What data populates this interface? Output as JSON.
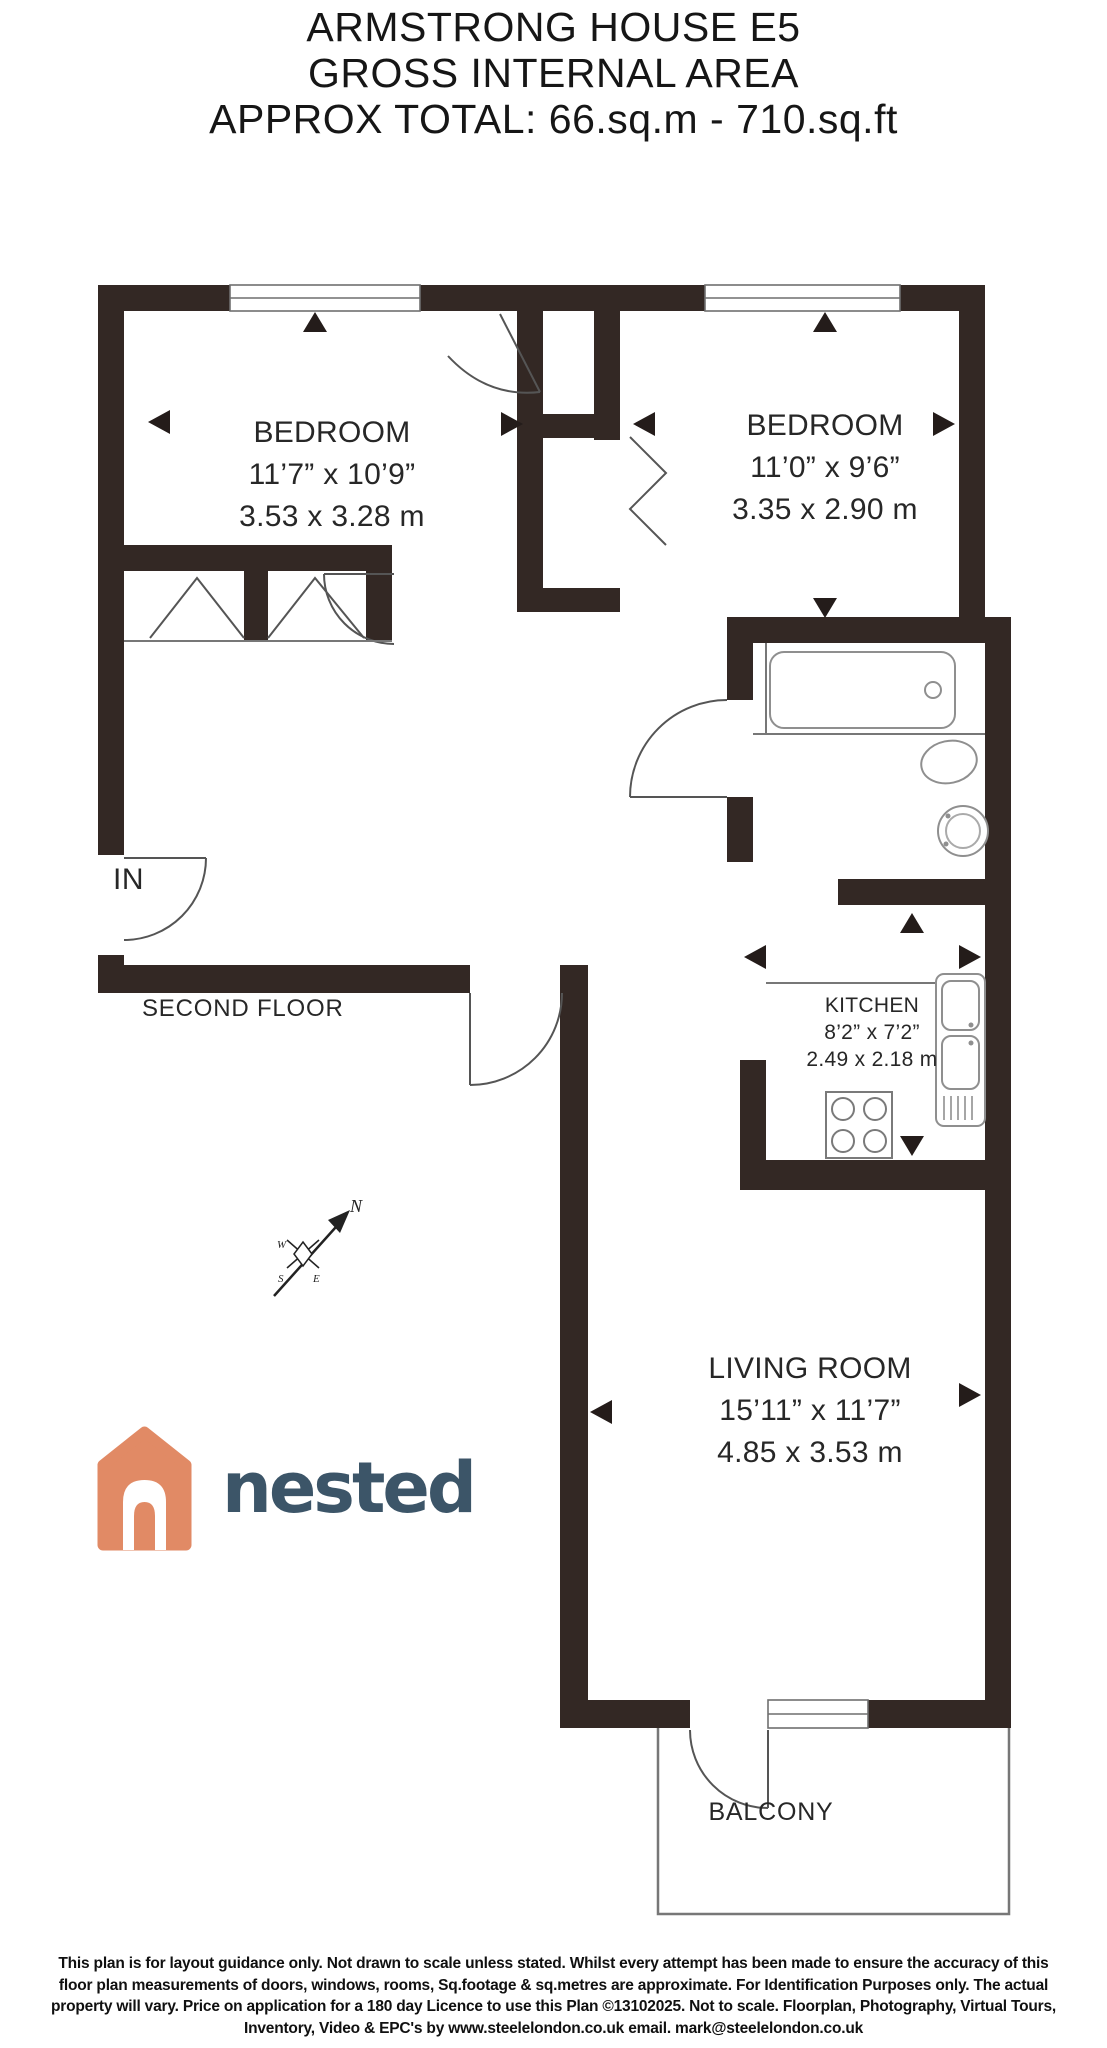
{
  "title": {
    "line1": "ARMSTRONG HOUSE E5",
    "line2": "GROSS INTERNAL AREA",
    "line3": "APPROX TOTAL: 66.sq.m - 710.sq.ft"
  },
  "entrance_label": "IN",
  "floor_label": "SECOND FLOOR",
  "rooms": {
    "bedroom1": {
      "name": "BEDROOM",
      "imperial": "11’7” x 10’9”",
      "metric": "3.53 x 3.28 m"
    },
    "bedroom2": {
      "name": "BEDROOM",
      "imperial": "11’0” x 9’6”",
      "metric": "3.35 x 2.90 m"
    },
    "kitchen": {
      "name": "KITCHEN",
      "imperial": "8’2” x 7’2”",
      "metric": "2.49 x 2.18 m"
    },
    "living_room": {
      "name": "LIVING ROOM",
      "imperial": "15’11” x 11’7”",
      "metric": "4.85 x 3.53 m"
    },
    "balcony": {
      "name": "BALCONY"
    }
  },
  "compass": {
    "n": "N",
    "e": "E",
    "s": "S",
    "w": "W"
  },
  "logo": {
    "text": "nested",
    "icon_color": "#E18A65",
    "text_color": "#3C5568"
  },
  "colors": {
    "wall": "#332824",
    "label_text": "#272727"
  },
  "disclaimer": {
    "lines": [
      "This plan is for layout guidance only. Not drawn to scale unless stated. Whilst every attempt has been made to ensure the accuracy of this",
      "floor plan measurements of doors, windows, rooms, Sq.footage & sq.metres are approximate. For Identification Purposes only. The actual",
      "property will vary. Price on application for a 180 day Licence to use this Plan ©13102025. Not to scale. Floorplan, Photography, Virtual Tours,",
      "Inventory, Video & EPC's by www.steelelondon.co.uk  email. mark@steelelondon.co.uk"
    ]
  }
}
